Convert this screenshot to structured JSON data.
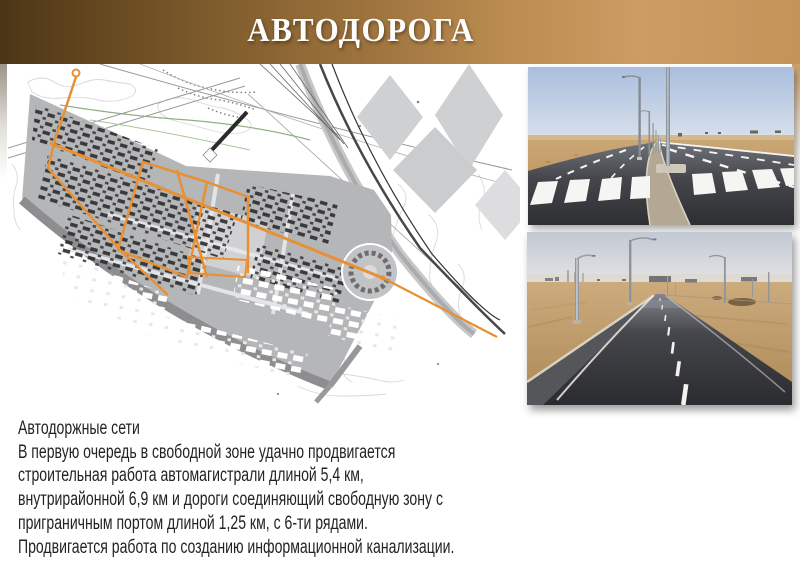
{
  "slide": {
    "title": "АВТОДОРОГА",
    "body_lines": [
      "Автодоржные сети",
      "В первую очередь в свободной зоне удачно продвигается",
      "строительная работа автомагистрали длиной 5,4 км,",
      "внутрирайонной 6,9 км и дороги соединяющий свободную зону с",
      "приграничным портом длиной 1,25 км, с 6-ти рядами.",
      "Продвигается работа по созданию информационной канализации."
    ],
    "colors": {
      "banner_dark": "#4b3517",
      "banner_light": "#c89a5f",
      "road_network_orange": "#e89034",
      "plan_gray": "#b5b6b8",
      "body_text": "#232323"
    }
  }
}
